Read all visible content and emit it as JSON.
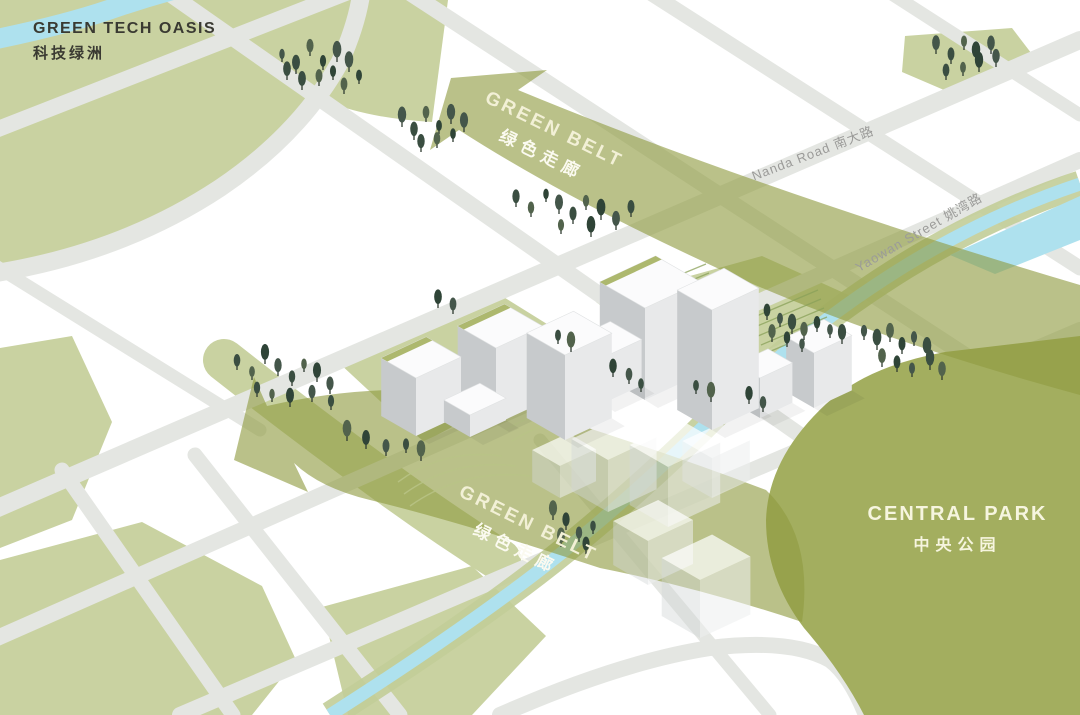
{
  "labels": {
    "oasis_en": "GREEN TECH OASIS",
    "oasis_zh": "科技绿洲",
    "park_en": "CENTRAL PARK",
    "park_zh": "中央公园",
    "belt_en": "GREEN BELT",
    "belt_zh": "绿色走廊",
    "nanda": "Nanda Road 南大路",
    "yaowan": "Yaowan Street 姚湾路"
  },
  "colors": {
    "bg": "#ffffff",
    "sage": "#c9d2a1",
    "park": "#a3ae5f",
    "band": "#8f9b40",
    "canal": "#aee1ee",
    "canalVerge": "#c2cd98",
    "road": "#e4e6e2",
    "inkDark": "#3a3a32",
    "roadText": "#9b9b99",
    "beltText": "#f2f0d6",
    "beltTextZh": "#fbfaf0",
    "parkText": "#f6f5df",
    "bldLeft": "#c7cacc",
    "bldRight": "#e8e9ea",
    "bldTop": "#fbfbfc",
    "roofGreen": "#a9b466",
    "trunk": "#2f3b31",
    "hatch": "#8aa159",
    "contour": "#b9c487"
  },
  "band_opacity": 0.62,
  "tree_colors": [
    "#44564a",
    "#3a4e41",
    "#52634c",
    "#2f4437"
  ],
  "buildings": [
    {
      "x": 416,
      "y": 436,
      "w": 50,
      "d": 40,
      "h": 58,
      "roof": true
    },
    {
      "x": 470,
      "y": 437,
      "w": 40,
      "d": 30,
      "h": 22
    },
    {
      "x": 496,
      "y": 424,
      "w": 52,
      "d": 44,
      "h": 76,
      "roof": true
    },
    {
      "x": 565,
      "y": 440,
      "w": 52,
      "d": 44,
      "h": 85
    },
    {
      "x": 645,
      "y": 400,
      "w": 62,
      "d": 52,
      "h": 92,
      "roof": true
    },
    {
      "x": 602,
      "y": 404,
      "w": 44,
      "d": 36,
      "h": 46
    },
    {
      "x": 712,
      "y": 430,
      "w": 52,
      "d": 40,
      "h": 120
    },
    {
      "x": 760,
      "y": 418,
      "w": 36,
      "d": 28,
      "h": 40
    },
    {
      "x": 814,
      "y": 408,
      "w": 42,
      "d": 32,
      "h": 55
    }
  ],
  "ghost_buildings": [
    {
      "x": 560,
      "y": 498,
      "w": 40,
      "d": 32,
      "h": 32
    },
    {
      "x": 608,
      "y": 512,
      "w": 54,
      "d": 42,
      "h": 52
    },
    {
      "x": 668,
      "y": 527,
      "w": 58,
      "d": 44,
      "h": 60
    },
    {
      "x": 712,
      "y": 498,
      "w": 42,
      "d": 34,
      "h": 40
    },
    {
      "x": 648,
      "y": 585,
      "w": 50,
      "d": 40,
      "h": 44
    },
    {
      "x": 700,
      "y": 638,
      "w": 56,
      "d": 44,
      "h": 58
    }
  ],
  "trees": [
    [
      282,
      62
    ],
    [
      296,
      74
    ],
    [
      310,
      56
    ],
    [
      323,
      70
    ],
    [
      337,
      62
    ],
    [
      302,
      90
    ],
    [
      319,
      86
    ],
    [
      333,
      80
    ],
    [
      349,
      72
    ],
    [
      287,
      80
    ],
    [
      344,
      94
    ],
    [
      359,
      84
    ],
    [
      402,
      127
    ],
    [
      414,
      140
    ],
    [
      426,
      122
    ],
    [
      439,
      134
    ],
    [
      451,
      124
    ],
    [
      421,
      152
    ],
    [
      437,
      148
    ],
    [
      453,
      142
    ],
    [
      464,
      132
    ],
    [
      516,
      207
    ],
    [
      531,
      217
    ],
    [
      546,
      202
    ],
    [
      559,
      214
    ],
    [
      573,
      224
    ],
    [
      586,
      210
    ],
    [
      601,
      220
    ],
    [
      616,
      230
    ],
    [
      631,
      217
    ],
    [
      561,
      234
    ],
    [
      591,
      237
    ],
    [
      936,
      54
    ],
    [
      951,
      64
    ],
    [
      964,
      50
    ],
    [
      976,
      62
    ],
    [
      991,
      54
    ],
    [
      946,
      80
    ],
    [
      963,
      76
    ],
    [
      979,
      72
    ],
    [
      996,
      67
    ],
    [
      237,
      370
    ],
    [
      252,
      380
    ],
    [
      265,
      364
    ],
    [
      278,
      376
    ],
    [
      292,
      386
    ],
    [
      304,
      372
    ],
    [
      317,
      382
    ],
    [
      330,
      394
    ],
    [
      257,
      397
    ],
    [
      272,
      402
    ],
    [
      290,
      407
    ],
    [
      312,
      402
    ],
    [
      331,
      410
    ],
    [
      347,
      441
    ],
    [
      366,
      449
    ],
    [
      386,
      456
    ],
    [
      406,
      453
    ],
    [
      421,
      461
    ],
    [
      438,
      308
    ],
    [
      453,
      314
    ],
    [
      558,
      344
    ],
    [
      571,
      352
    ],
    [
      613,
      377
    ],
    [
      629,
      384
    ],
    [
      696,
      394
    ],
    [
      711,
      402
    ],
    [
      749,
      404
    ],
    [
      763,
      412
    ],
    [
      641,
      392
    ],
    [
      553,
      520
    ],
    [
      566,
      530
    ],
    [
      579,
      542
    ],
    [
      593,
      534
    ],
    [
      561,
      547
    ],
    [
      586,
      554
    ],
    [
      864,
      340
    ],
    [
      877,
      350
    ],
    [
      890,
      342
    ],
    [
      902,
      354
    ],
    [
      914,
      346
    ],
    [
      927,
      358
    ],
    [
      882,
      367
    ],
    [
      897,
      372
    ],
    [
      912,
      377
    ],
    [
      930,
      370
    ],
    [
      942,
      380
    ],
    [
      767,
      320
    ],
    [
      780,
      327
    ],
    [
      792,
      334
    ],
    [
      804,
      340
    ],
    [
      817,
      332
    ],
    [
      830,
      338
    ],
    [
      842,
      344
    ],
    [
      772,
      342
    ],
    [
      787,
      347
    ],
    [
      802,
      352
    ]
  ]
}
